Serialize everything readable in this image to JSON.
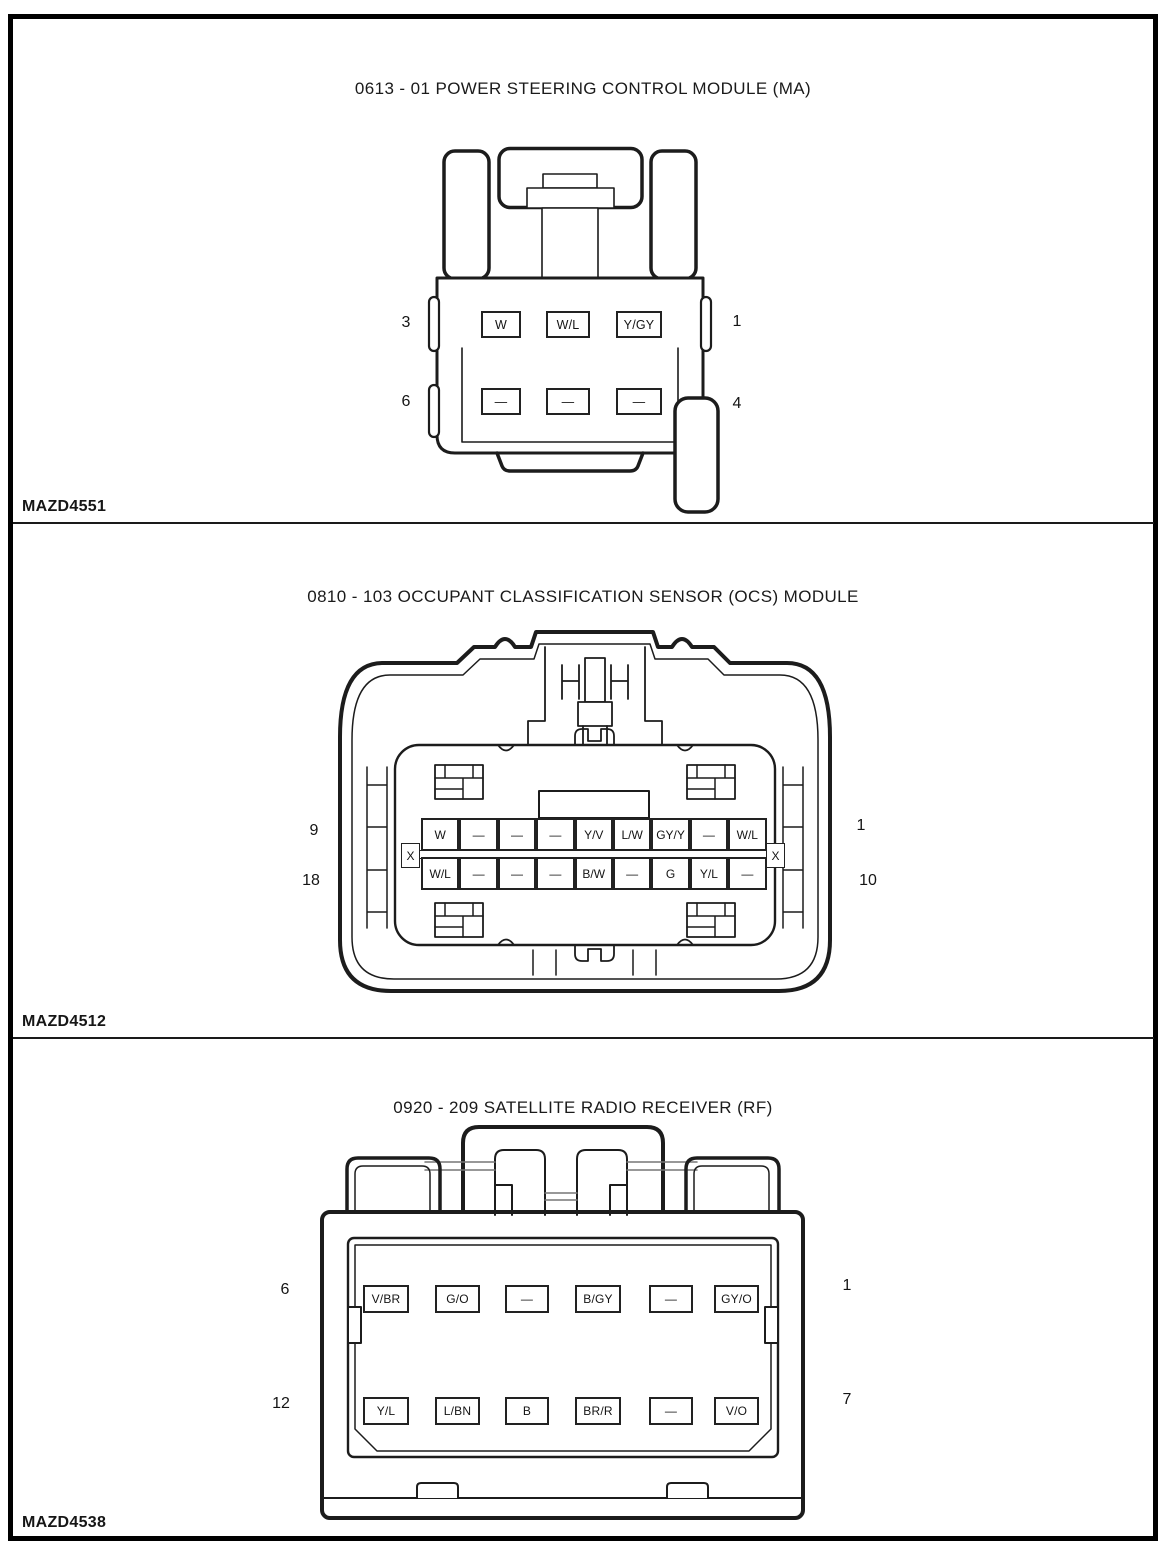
{
  "colors": {
    "background": "#ffffff",
    "line": "#1c1c1c",
    "frame": "#000000"
  },
  "panels": [
    {
      "title": "0613 - 01 POWER STEERING CONTROL MODULE (MA)",
      "figure_code": "MAZD4551",
      "pin_numbers": {
        "top_left": "3",
        "top_right": "1",
        "bottom_left": "6",
        "bottom_right": "4"
      },
      "rows": [
        [
          "W",
          "W/L",
          "Y/GY"
        ],
        [
          "—",
          "—",
          "—"
        ]
      ]
    },
    {
      "title": "0810 - 103 OCCUPANT CLASSIFICATION SENSOR (OCS) MODULE",
      "figure_code": "MAZD4512",
      "pin_numbers": {
        "top_left": "9",
        "top_right": "1",
        "bottom_left": "18",
        "bottom_right": "10"
      },
      "key_symbol": "X",
      "rows": [
        [
          "W",
          "—",
          "—",
          "—",
          "Y/V",
          "L/W",
          "GY/Y",
          "—",
          "W/L"
        ],
        [
          "W/L",
          "—",
          "—",
          "—",
          "B/W",
          "—",
          "G",
          "Y/L",
          "—"
        ]
      ]
    },
    {
      "title": "0920 - 209 SATELLITE RADIO RECEIVER (RF)",
      "figure_code": "MAZD4538",
      "pin_numbers": {
        "top_left": "6",
        "top_right": "1",
        "bottom_left": "12",
        "bottom_right": "7"
      },
      "rows": [
        [
          "V/BR",
          "G/O",
          "—",
          "B/GY",
          "—",
          "GY/O"
        ],
        [
          "Y/L",
          "L/BN",
          "B",
          "BR/R",
          "—",
          "V/O"
        ]
      ]
    }
  ]
}
